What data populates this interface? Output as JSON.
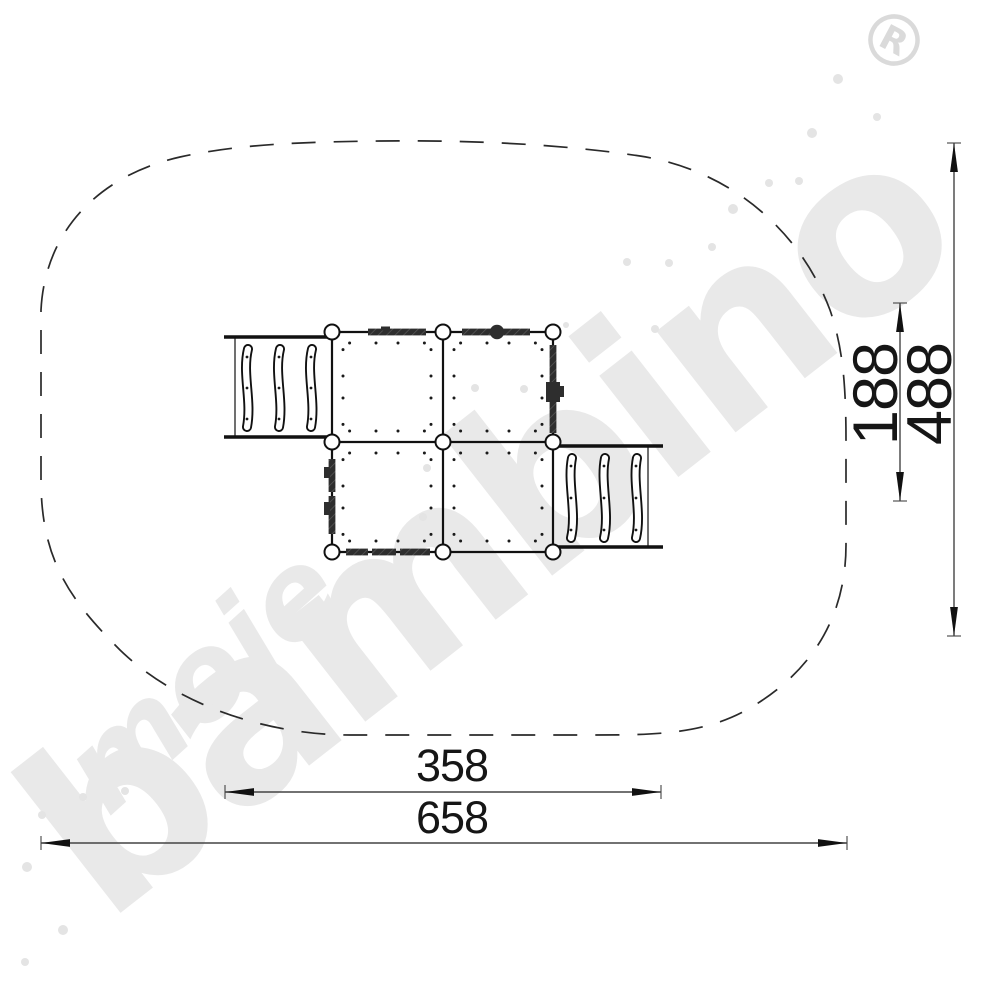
{
  "watermark": {
    "word_small": "moje",
    "word_main": "bambino",
    "registered_mark": "R",
    "color": "#e9e9e9"
  },
  "dimensions": {
    "inner_width": "358",
    "outer_width": "658",
    "inner_height": "188",
    "outer_height": "488"
  },
  "colors": {
    "line": "#1a1a1a",
    "dimension_line": "#444444",
    "panel_dark": "#2e2e2e",
    "watermark_gray": "#e9e9e9"
  }
}
